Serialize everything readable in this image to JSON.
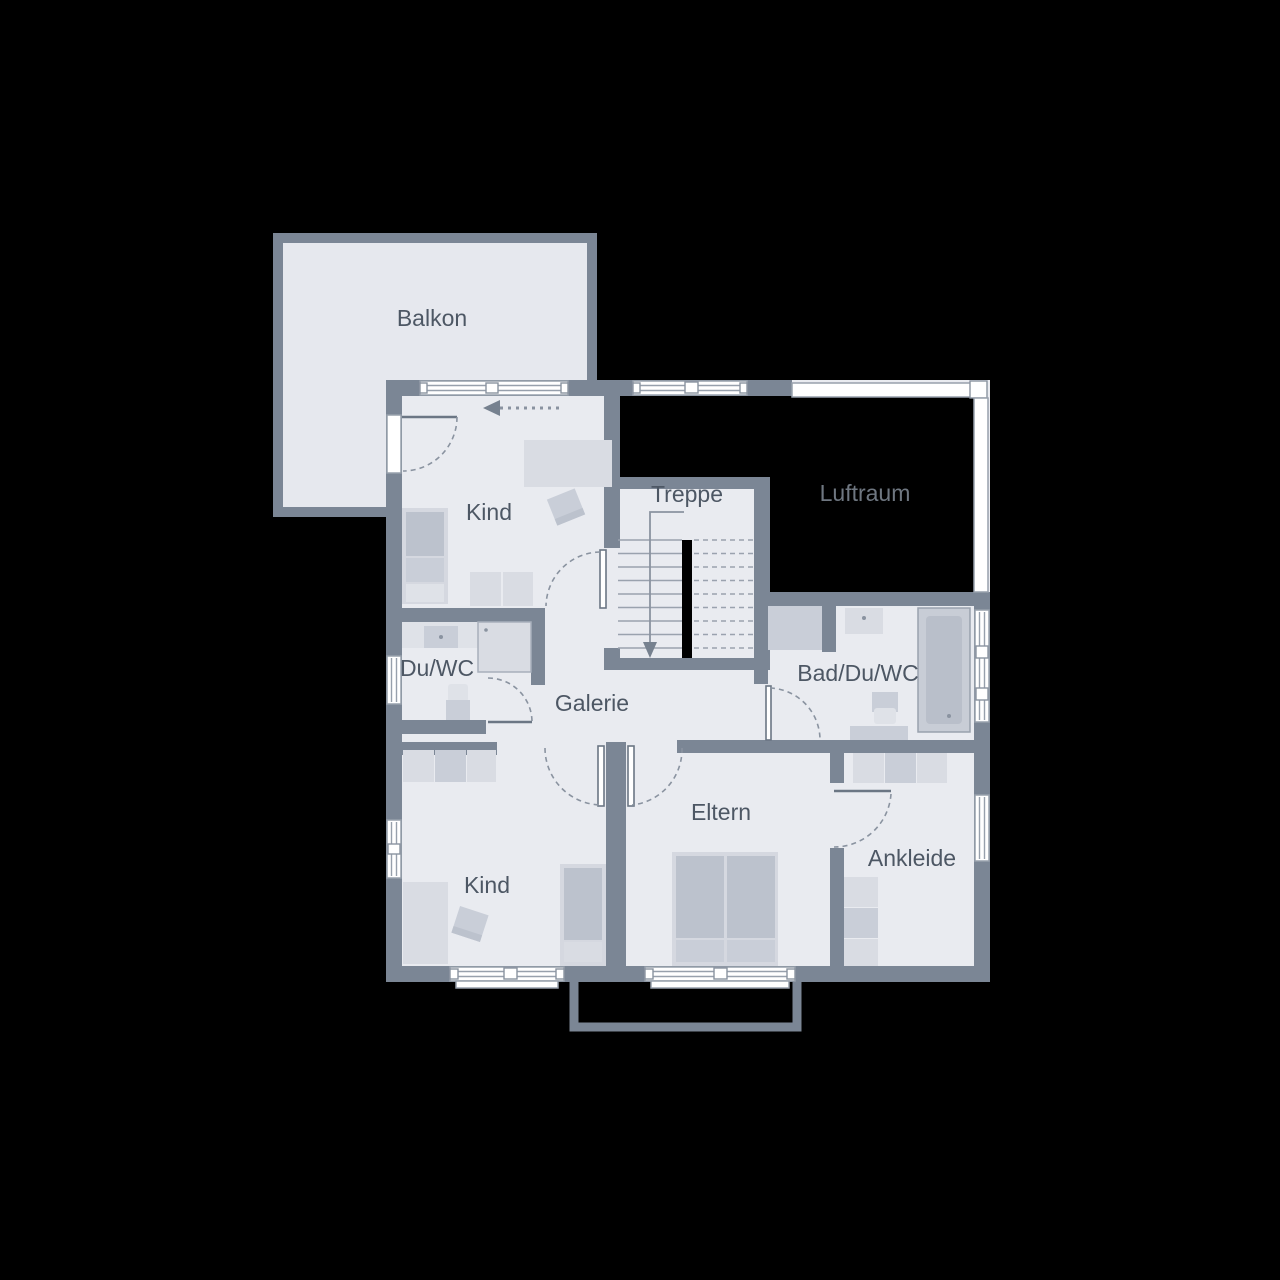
{
  "rooms": {
    "balkon": {
      "label": "Balkon"
    },
    "kind_top": {
      "label": "Kind"
    },
    "treppe": {
      "label": "Treppe"
    },
    "luftraum": {
      "label": "Luftraum"
    },
    "du_wc": {
      "label": "Du/WC"
    },
    "galerie": {
      "label": "Galerie"
    },
    "bad_du_wc": {
      "label": "Bad/Du/WC"
    },
    "eltern": {
      "label": "Eltern"
    },
    "kind_bottom": {
      "label": "Kind"
    },
    "ankleide": {
      "label": "Ankleide"
    }
  },
  "colors": {
    "background": "#000000",
    "wall": "#7b8695",
    "floor": "#e9ebf0",
    "balcony_floor": "#e6e8ee",
    "window": "#ffffff",
    "label_text": "#4d5764",
    "luftraum_text": "#6f7781",
    "furniture_light": "#d9dce3",
    "furniture_mid": "#c9ced8",
    "furniture_dark": "#bcc2cd",
    "stair_handrail": "#000000"
  }
}
